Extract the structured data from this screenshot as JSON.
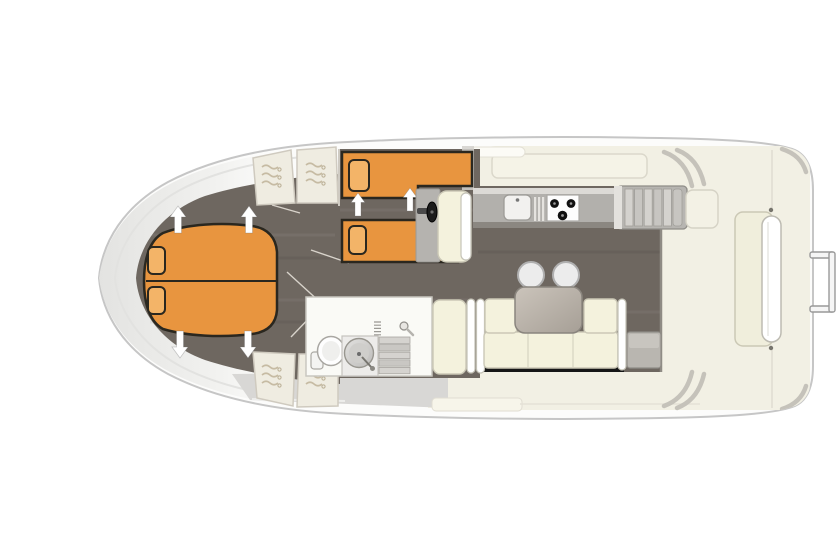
{
  "diagram": {
    "type": "boat-floor-plan",
    "view": "top-down",
    "orientation": "bow-left",
    "rooms": [
      {
        "name": "bow-cabin",
        "items": [
          "double-v-berth",
          "pillow-port",
          "pillow-starboard",
          "wardrobe-fore-port",
          "wardrobe-fore-starboard",
          "wardrobe-aft-port",
          "wardrobe-aft-starboard",
          "hatch-arrow-up-1",
          "hatch-arrow-up-2",
          "hatch-arrow-down-1",
          "hatch-arrow-down-2"
        ]
      },
      {
        "name": "mid-cabin",
        "items": [
          "single-berth-fore",
          "single-berth-aft",
          "pillow-fore",
          "pillow-aft",
          "hatch-arrow-1",
          "hatch-arrow-2"
        ]
      },
      {
        "name": "helm-station",
        "items": [
          "steering-wheel",
          "helm-console",
          "helm-seat"
        ]
      },
      {
        "name": "galley",
        "items": [
          "worktop",
          "sink",
          "drainboard",
          "three-burner-stove",
          "companionway-steps"
        ]
      },
      {
        "name": "bathroom",
        "items": [
          "toilet",
          "washbasin",
          "faucet",
          "shower-head",
          "entry-steps",
          "vent-coil"
        ]
      },
      {
        "name": "saloon",
        "items": [
          "side-bench",
          "l-shaped-sofa",
          "sofa-armrests",
          "dining-table",
          "stool-1",
          "stool-2",
          "storage-bench"
        ]
      },
      {
        "name": "aft-deck",
        "items": [
          "deck-console",
          "bench-seat",
          "bench-backrest-roll",
          "corner-steps",
          "transom-handle",
          "deck-locker"
        ]
      }
    ],
    "counts": {
      "berths": 4,
      "cabins": 2,
      "direction_arrows": 6,
      "stools": 2,
      "stove_burners": 3,
      "wardrobes": 4
    },
    "colors": {
      "berth": "#E8953F",
      "pillow": "#F3B468",
      "outline": "#2A271F",
      "floor": "#6E6760",
      "deck": "#F2F0E4",
      "gray_deck": "#D8D7D5",
      "upholstery": "#F4F2DD",
      "table_light": "#CBC4BB",
      "table_dark": "#A69F96",
      "counter": "#B2B0AC",
      "hull": "#FCFCFB",
      "dark_wall": "#161616"
    }
  }
}
